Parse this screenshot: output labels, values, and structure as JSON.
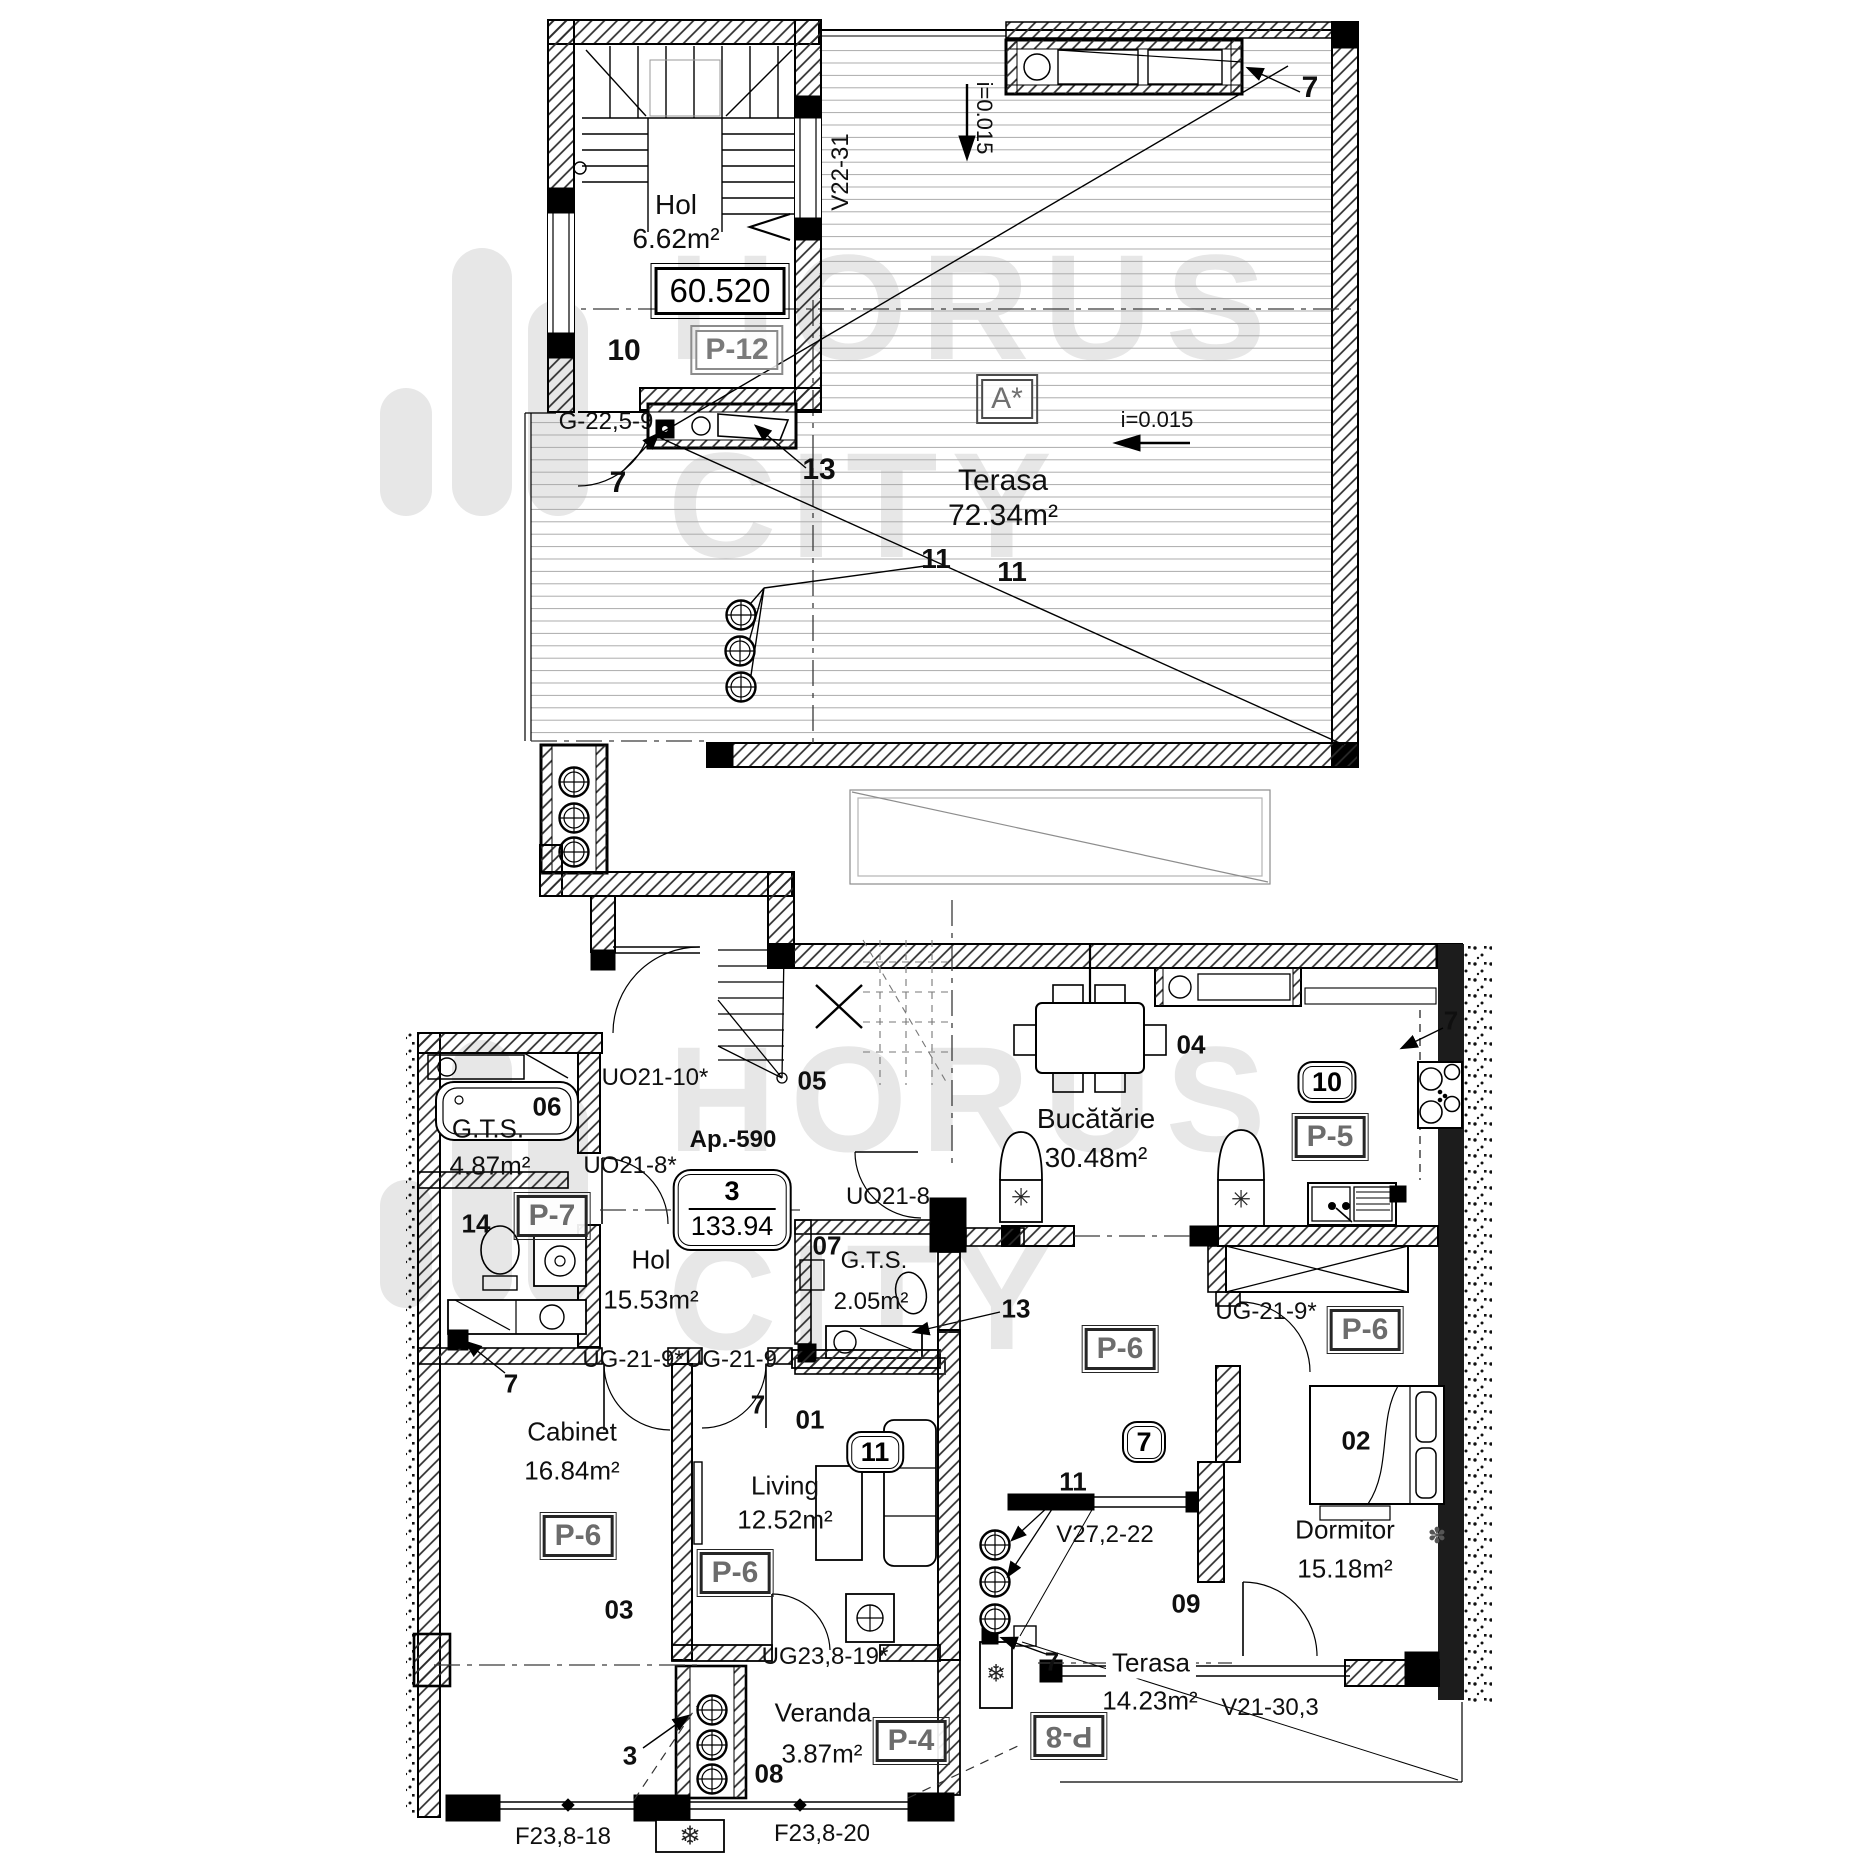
{
  "watermark": {
    "line1": "HORUS",
    "line2": "CITY"
  },
  "icons": {
    "fridge_mark": "✳",
    "boiler_mark": "✳",
    "ac_mark": "❄",
    "flower_mark": "✽"
  },
  "upper": {
    "hol_name": "Hol",
    "hol_area": "6.62m²",
    "level_value": "60.520",
    "p12": "P-12",
    "num10": "10",
    "v22_31": "V22-31",
    "slope_vertical": "i=0.015",
    "slope_horizontal": "i=0.015",
    "a_star": "A*",
    "terasa_name": "Terasa",
    "terasa_area": "72.34m²",
    "num13": "13",
    "g_22_5_9": "G-22,5-9",
    "num7_mid": "7",
    "num7_corner": "7",
    "num11_a": "11",
    "num11_b": "11"
  },
  "lower": {
    "gts06_num": "06",
    "gts06_name": "G.T.S.",
    "gts06_area": "4.87m²",
    "uo21_10": "UO21-10*",
    "num05": "05",
    "num04": "04",
    "kitchen_name": "Bucătărie",
    "kitchen_area": "30.48m²",
    "badge10": "10",
    "p5": "P-5",
    "num7_kitchen": "7",
    "ap_number": "Ap.-590",
    "ap_rooms": "3",
    "ap_area": "133.94",
    "hol_name": "Hol",
    "hol_area": "15.53m²",
    "p7": "P-7",
    "num14": "14",
    "uo21_8s": "UO21-8*",
    "uo21_8": "UO21-8",
    "gts07_num": "07",
    "gts07_name": "G.T.S.",
    "gts07_area": "2.05m²",
    "num13": "13",
    "ug21_9s_a": "UG-21-9*",
    "ug21_9": "UG-21-9",
    "ug21_9s_b": "UG-21-9*",
    "num7_left": "7",
    "num7_doors": "7",
    "cabinet_name": "Cabinet",
    "cabinet_area": "16.84m²",
    "p6_cabinet": "P-6",
    "num03": "03",
    "num01": "01",
    "badge11": "11",
    "living_name": "Living",
    "living_area": "12.52m²",
    "p6_living": "P-6",
    "p6_mid": "P-6",
    "badge7": "7",
    "num02": "02",
    "p6_dorm": "P-6",
    "dorm_name": "Dormitor",
    "dorm_area": "15.18m²",
    "num11_living": "11",
    "v27_2_22": "V27,2-22",
    "num09": "09",
    "ug23_8_19": "UG23,8-19*",
    "veranda_name": "Veranda",
    "veranda_area": "3.87m²",
    "num08": "08",
    "p4": "P-4",
    "num3": "3",
    "num7_terasa": "7",
    "p8": "P-8",
    "terasa_name": "Terasa",
    "terasa_area": "14.23m²",
    "v21_30_3": "V21-30,3",
    "f23_8_18": "F23,8-18",
    "f23_8_20": "F23,8-20"
  }
}
